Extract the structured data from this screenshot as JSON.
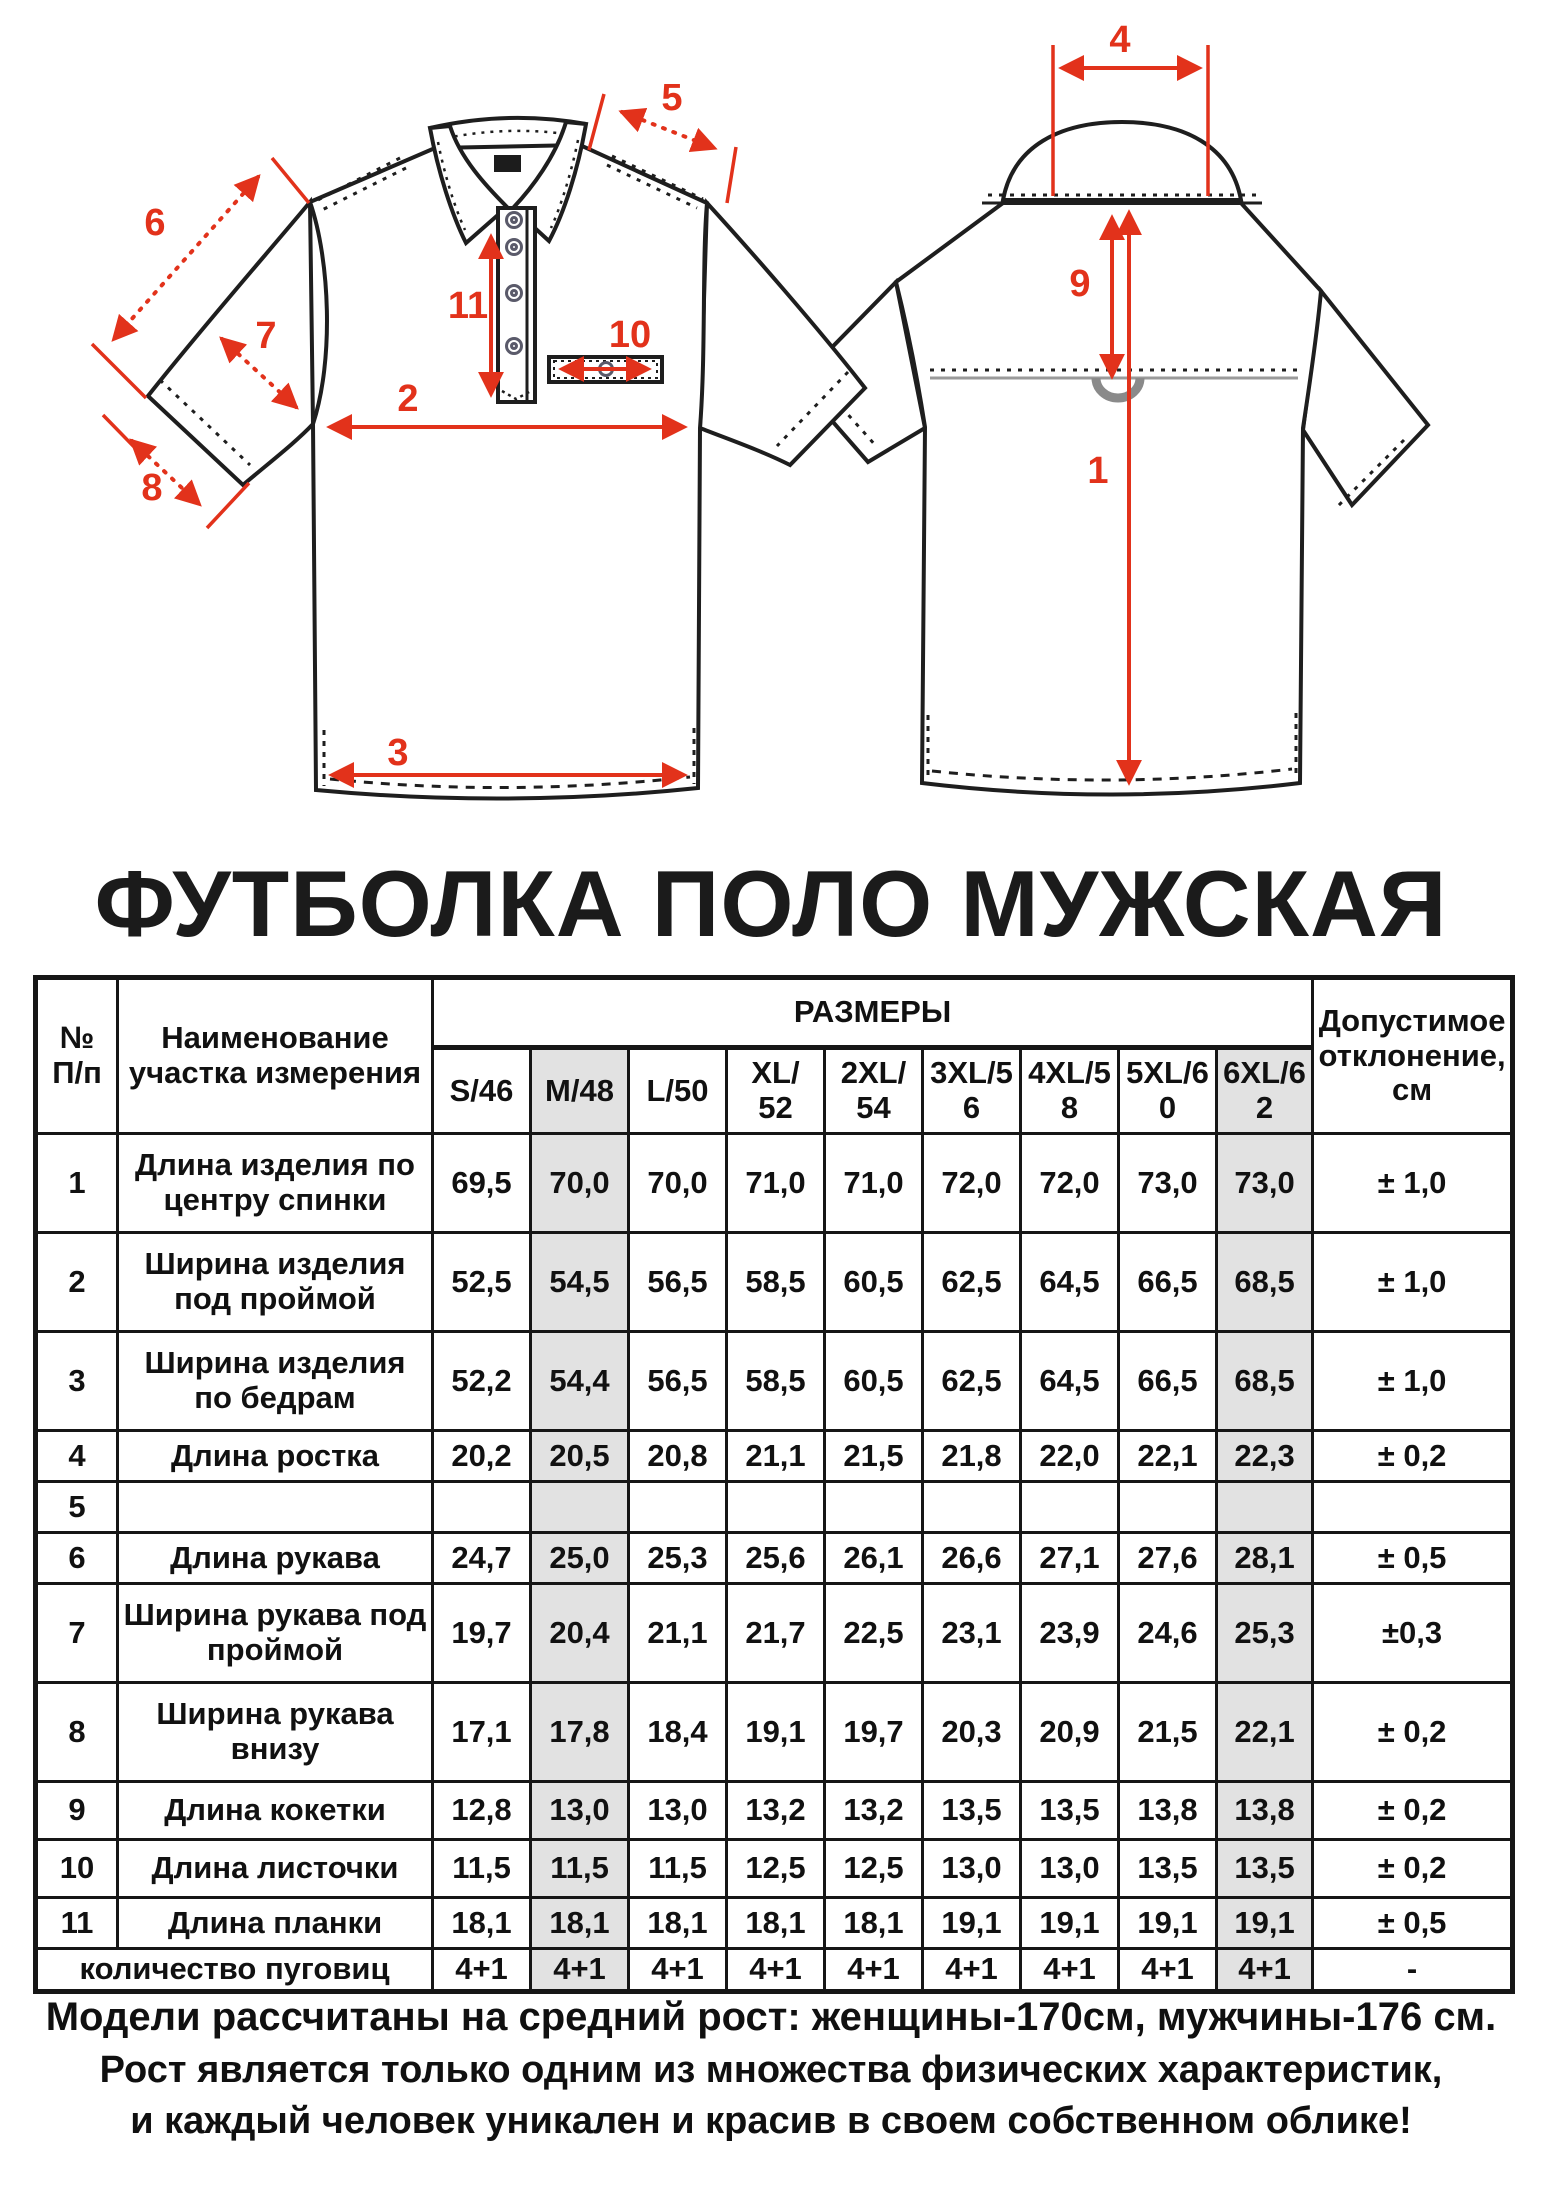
{
  "colors": {
    "red": "#e2321b",
    "line": "#1e1e1e",
    "highlight": "#e2e2e2"
  },
  "diagram": {
    "labels": {
      "n1": "1",
      "n2": "2",
      "n3": "3",
      "n4": "4",
      "n5": "5",
      "n6": "6",
      "n7": "7",
      "n8": "8",
      "n9": "9",
      "n10": "10",
      "n11": "11"
    }
  },
  "title": "ФУТБОЛКА ПОЛО МУЖСКАЯ",
  "table": {
    "corner_top": "№",
    "corner_bottom": "П/п",
    "name_header": "Наименование\nучастка измерения",
    "sizes_header": "РАЗМЕРЫ",
    "size_columns": [
      "S/46",
      "M/48",
      "L/50",
      "XL/\n52",
      "2XL/\n54",
      "3XL/5\n6",
      "4XL/5\n8",
      "5XL/6\n0",
      "6XL/6\n2"
    ],
    "tolerance_header": "Допустимое отклонение, см",
    "rows": [
      {
        "num": "1",
        "name": "Длина изделия по центру спинки",
        "values": [
          "69,5",
          "70,0",
          "70,0",
          "71,0",
          "71,0",
          "72,0",
          "72,0",
          "73,0",
          "73,0"
        ],
        "tol": "± 1,0"
      },
      {
        "num": "2",
        "name": "Ширина изделия под проймой",
        "values": [
          "52,5",
          "54,5",
          "56,5",
          "58,5",
          "60,5",
          "62,5",
          "64,5",
          "66,5",
          "68,5"
        ],
        "tol": "± 1,0"
      },
      {
        "num": "3",
        "name": "Ширина изделия по бедрам",
        "values": [
          "52,2",
          "54,4",
          "56,5",
          "58,5",
          "60,5",
          "62,5",
          "64,5",
          "66,5",
          "68,5"
        ],
        "tol": "± 1,0"
      },
      {
        "num": "4",
        "name": "Длина ростка",
        "values": [
          "20,2",
          "20,5",
          "20,8",
          "21,1",
          "21,5",
          "21,8",
          "22,0",
          "22,1",
          "22,3"
        ],
        "tol": "± 0,2"
      },
      {
        "num": "5",
        "name": "",
        "values": [
          "",
          "",
          "",
          "",
          "",
          "",
          "",
          "",
          ""
        ],
        "tol": ""
      },
      {
        "num": "6",
        "name": "Длина рукава",
        "values": [
          "24,7",
          "25,0",
          "25,3",
          "25,6",
          "26,1",
          "26,6",
          "27,1",
          "27,6",
          "28,1"
        ],
        "tol": "± 0,5"
      },
      {
        "num": "7",
        "name": "Ширина рукава под проймой",
        "values": [
          "19,7",
          "20,4",
          "21,1",
          "21,7",
          "22,5",
          "23,1",
          "23,9",
          "24,6",
          "25,3"
        ],
        "tol": "±0,3"
      },
      {
        "num": "8",
        "name": "Ширина рукава внизу",
        "values": [
          "17,1",
          "17,8",
          "18,4",
          "19,1",
          "19,7",
          "20,3",
          "20,9",
          "21,5",
          "22,1"
        ],
        "tol": "± 0,2"
      },
      {
        "num": "9",
        "name": "Длина кокетки",
        "values": [
          "12,8",
          "13,0",
          "13,0",
          "13,2",
          "13,2",
          "13,5",
          "13,5",
          "13,8",
          "13,8"
        ],
        "tol": "± 0,2"
      },
      {
        "num": "10",
        "name": "Длина листочки",
        "values": [
          "11,5",
          "11,5",
          "11,5",
          "12,5",
          "12,5",
          "13,0",
          "13,0",
          "13,5",
          "13,5"
        ],
        "tol": "± 0,2"
      },
      {
        "num": "11",
        "name": "Длина планки",
        "values": [
          "18,1",
          "18,1",
          "18,1",
          "18,1",
          "18,1",
          "19,1",
          "19,1",
          "19,1",
          "19,1"
        ],
        "tol": "± 0,5"
      }
    ],
    "buttons_row": {
      "name": "количество пуговиц",
      "values": [
        "4+1",
        "4+1",
        "4+1",
        "4+1",
        "4+1",
        "4+1",
        "4+1",
        "4+1",
        "4+1"
      ],
      "tol": "-"
    }
  },
  "footer": {
    "line1": "Модели рассчитаны на средний рост: женщины-170см, мужчины-176 см.",
    "line2": "Рост является только одним из множества физических характеристик,",
    "line3": "и каждый человек уникален и красив в своем собственном облике!"
  }
}
